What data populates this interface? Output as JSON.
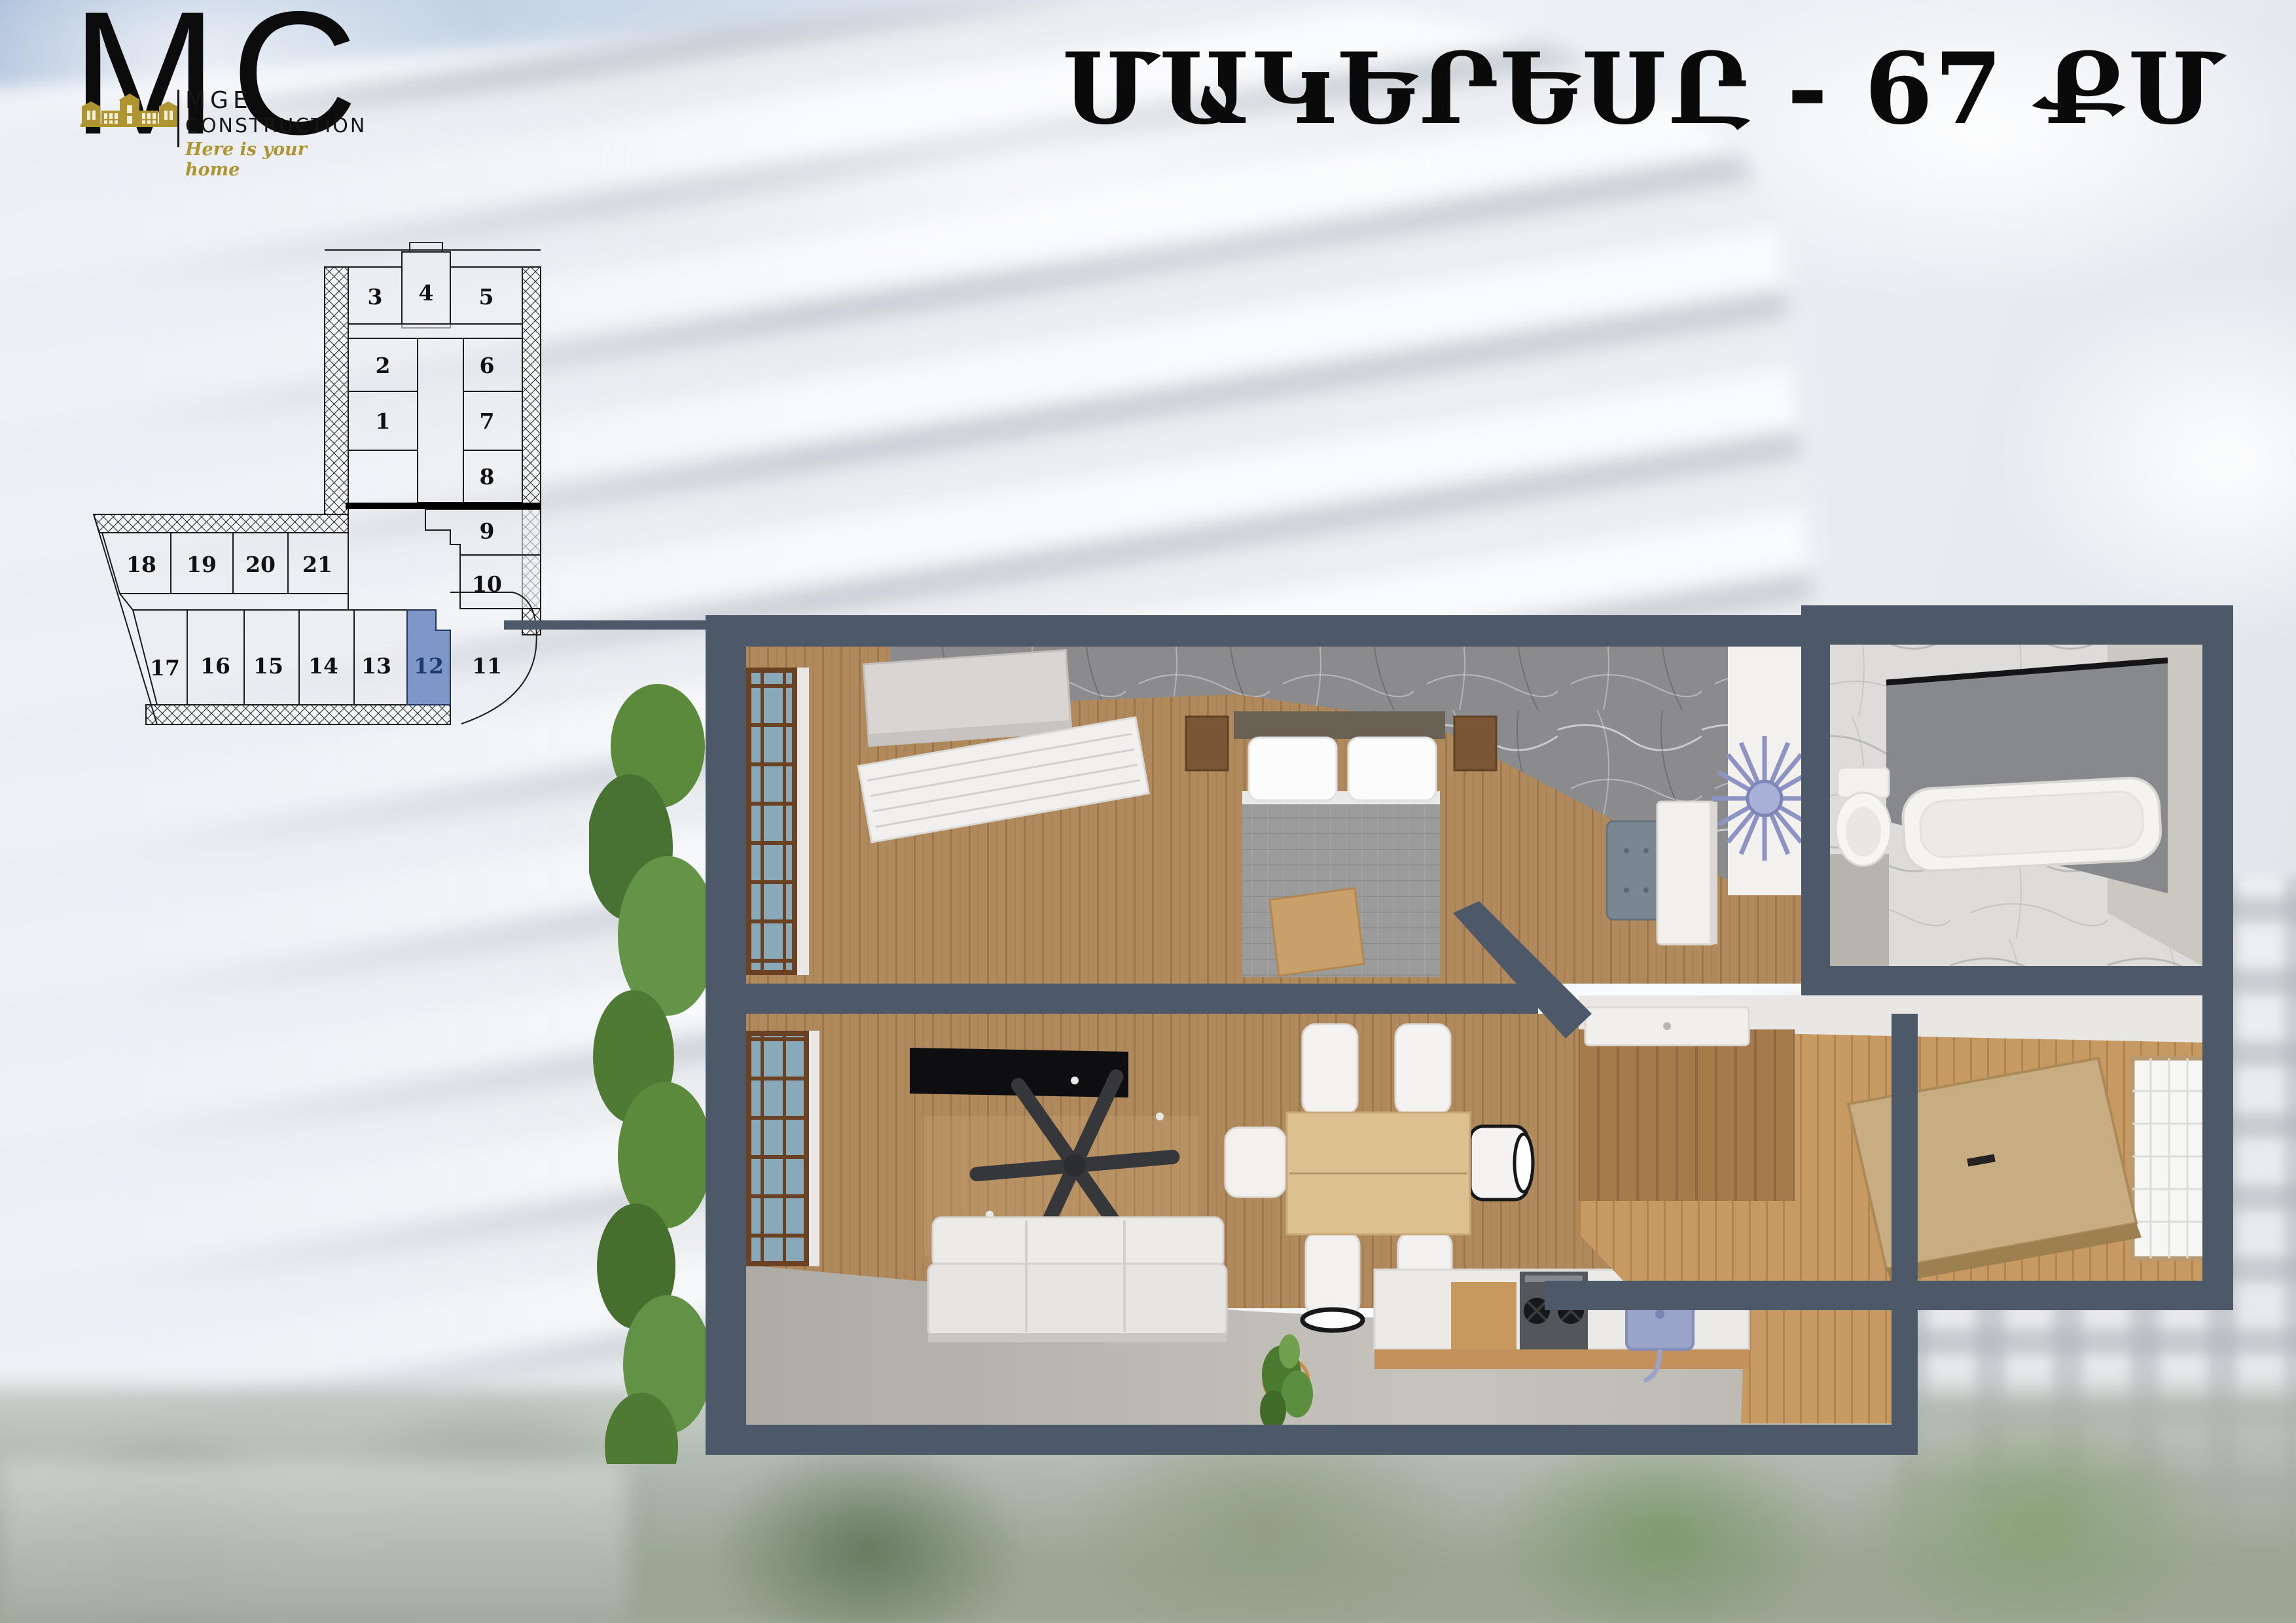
{
  "logo": {
    "monogram_m": "M",
    "monogram_c": "C",
    "company_line1": "MGE",
    "company_line2": "CONSTRUCTION",
    "tagline": "Here is your home"
  },
  "header": {
    "title": "ՄԱԿԵՐԵՍԸ - 67 ՔՄ"
  },
  "schematic": {
    "highlighted_unit": "12",
    "units": [
      "1",
      "2",
      "3",
      "4",
      "5",
      "6",
      "7",
      "8",
      "9",
      "10",
      "11",
      "12",
      "13",
      "14",
      "15",
      "16",
      "17",
      "18",
      "19",
      "20",
      "21"
    ]
  },
  "area_table": {
    "col_num": "N",
    "col_name": "ԱՆՎԱՆՈՒՄԸ",
    "col_area_line1": "ՄԱԿԵՐԵՍԸ",
    "col_area_line2": "ՔՄ",
    "rows": [
      {
        "num": "1",
        "name": "ՊԱՏՇԳԱՄԲ",
        "area": "8.7"
      },
      {
        "num": "2",
        "name": "ՆՆՋԱՍԵՆՅԱԿ",
        "area": "17.4"
      },
      {
        "num": "3",
        "name": "ԼՈԳԱՍԵՆՅԱԿ",
        "area": "3.5"
      },
      {
        "num": "4",
        "name": "ՀՅՈՒՐԱՍԵՆՅԱԿ ԵՎ ԽՈՀԱՆՈՑ",
        "area": "34.7"
      },
      {
        "num": "5",
        "name": "ՆԱԽԱՄՈՒՏՔ",
        "area": "2.7"
      }
    ]
  },
  "colors": {
    "highlight_unit": "#7E97C8",
    "plan_wall": "#4D5968",
    "logo_gold": "#AE9531"
  }
}
